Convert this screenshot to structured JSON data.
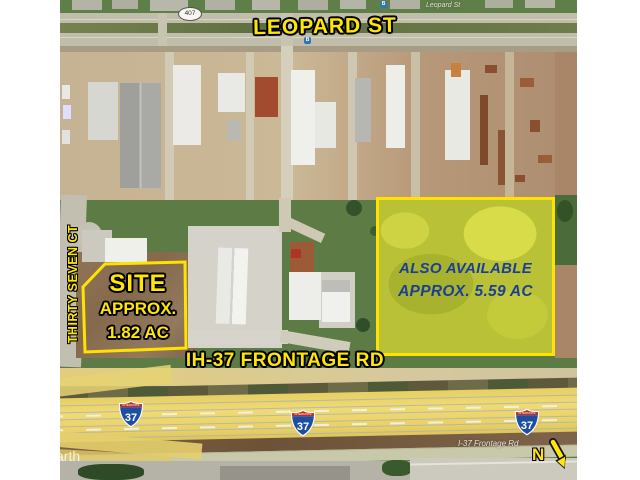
{
  "map": {
    "streets": {
      "leopard_big": "LEOPARD ST",
      "leopard_small": "Leopard St",
      "route_shield_407": "407",
      "thirty_seven_ct": "THIRTY SEVEN CT",
      "frontage_big": "IH-37 FRONTAGE RD",
      "frontage_small": "I-37 Frontage Rd"
    },
    "site_parcel": {
      "line1": "SITE",
      "line2": "APPROX.",
      "line3": "1.82 AC"
    },
    "also_available_parcel": {
      "line1": "ALSO AVAILABLE",
      "line2": "APPROX. 5.59 AC"
    },
    "interstate_shield": {
      "top_label": "INTERSTATE",
      "number": "37"
    },
    "compass": {
      "north": "N"
    },
    "bus_stop_label": "B",
    "watermark": "arth",
    "colors": {
      "annotation_yellow": "#ffe606",
      "outline_black": "#111111",
      "navy_text": "#1c3f93",
      "parcel_fill_yellow_green": "#b9c237",
      "highway_overlay_yellow": "#ecd46f",
      "shield_blue": "#1d4fa1",
      "shield_red": "#bf2b25",
      "dirt_brown": "#8b7154",
      "grass_green": "#5d7b44"
    }
  }
}
